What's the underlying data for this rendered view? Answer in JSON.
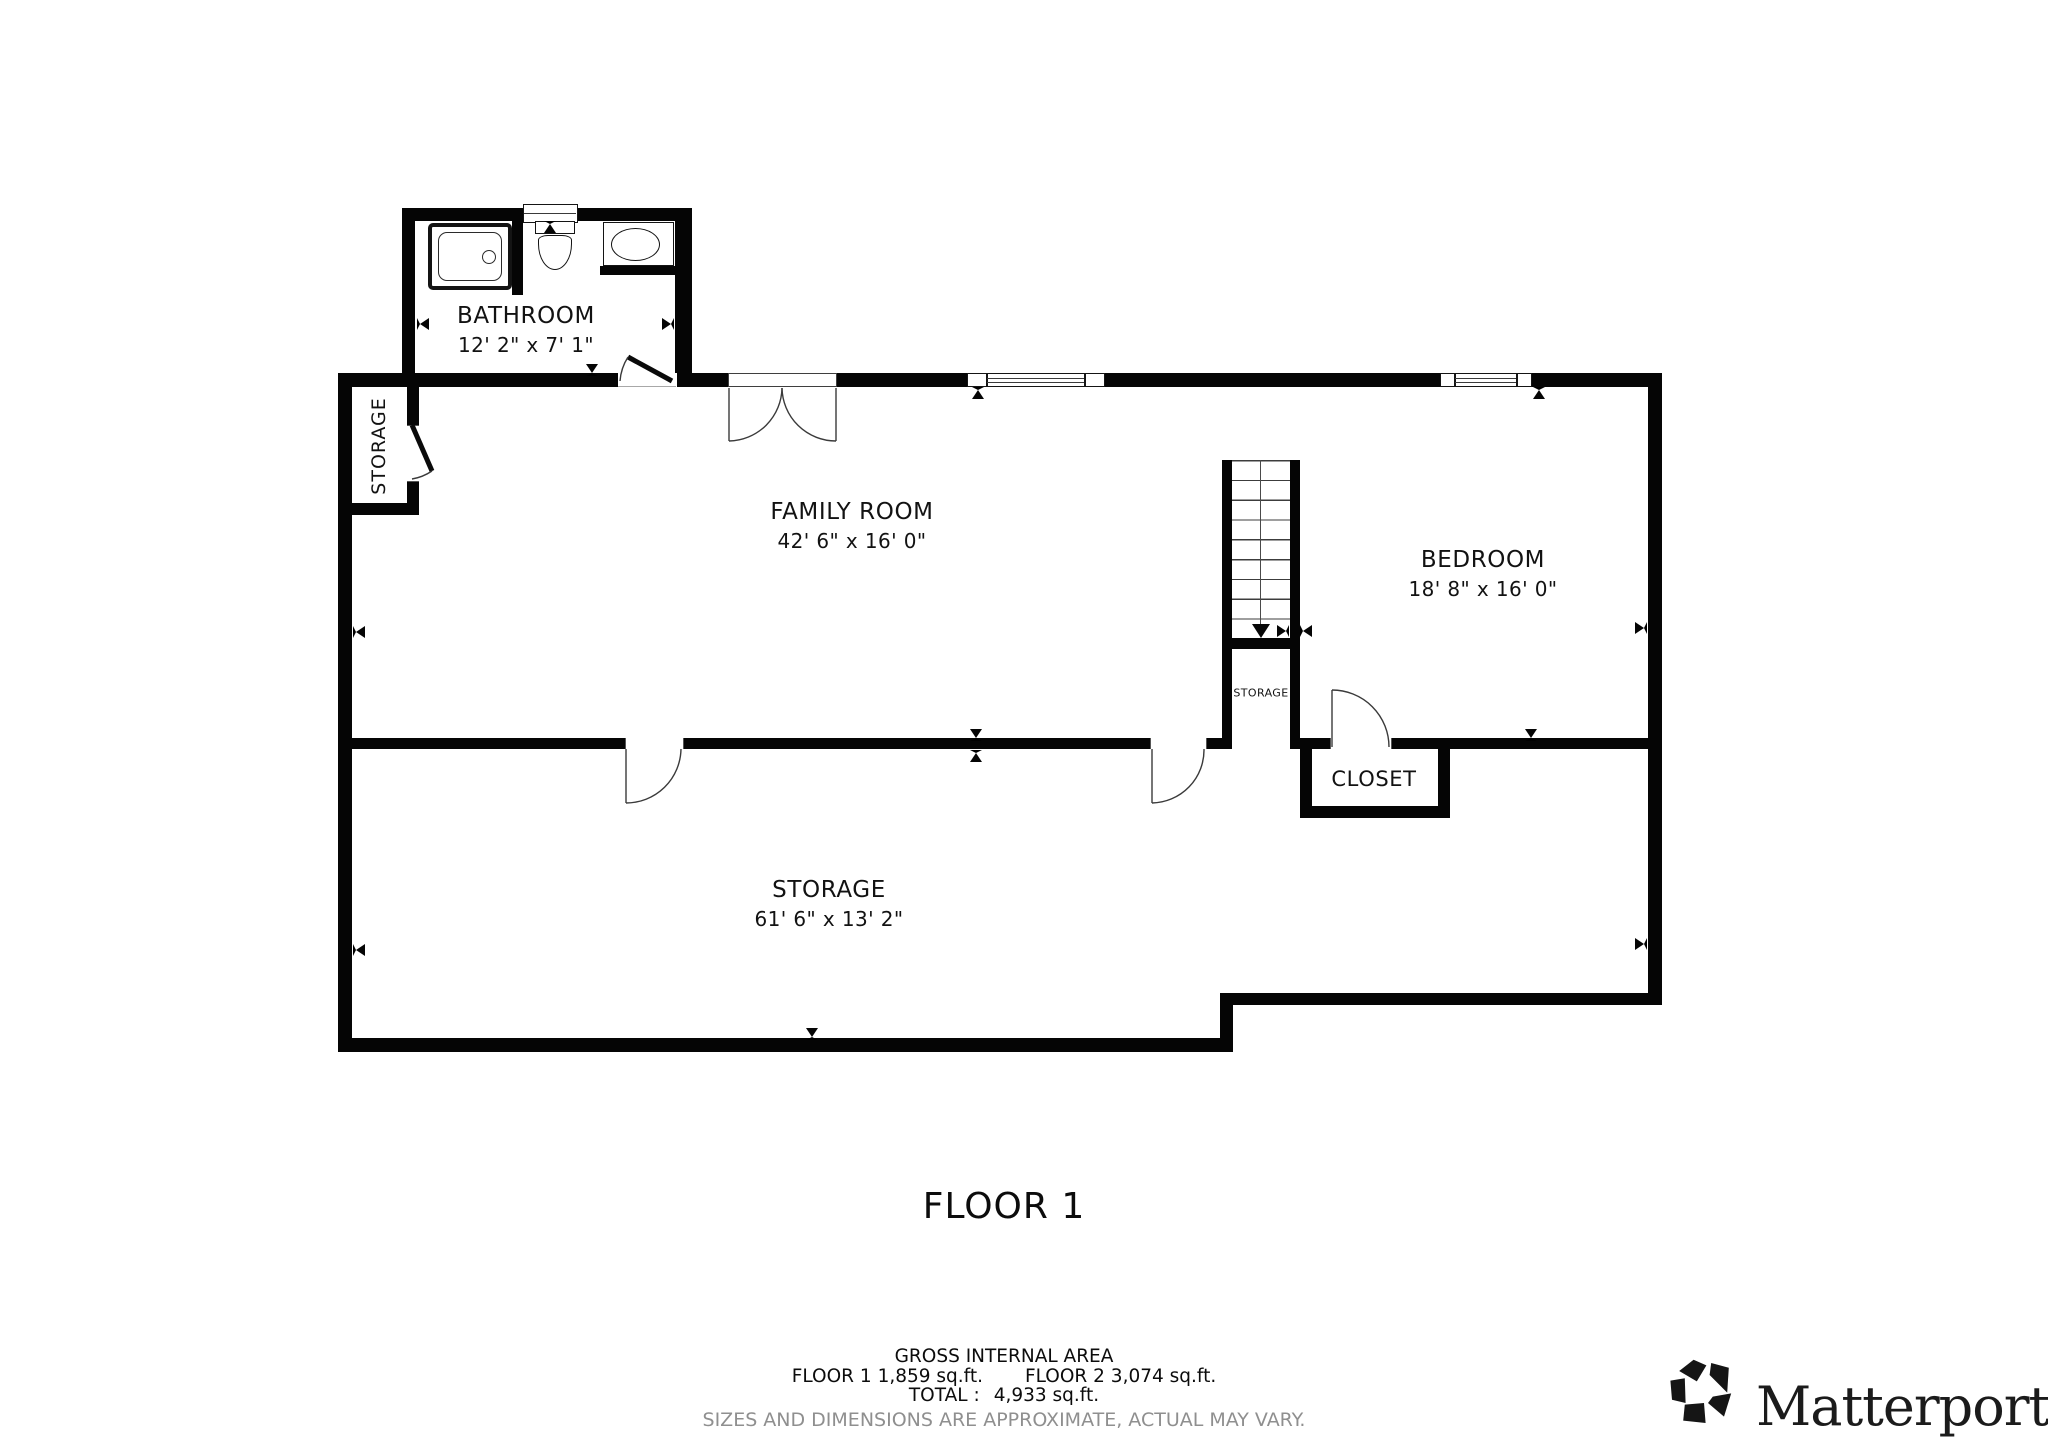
{
  "plan": {
    "title": "FLOOR 1",
    "rooms": {
      "bathroom": {
        "name": "BATHROOM",
        "dims": "12' 2\" x 7' 1\""
      },
      "family_room": {
        "name": "FAMILY ROOM",
        "dims": "42' 6\" x 16' 0\""
      },
      "bedroom": {
        "name": "BEDROOM",
        "dims": "18' 8\" x 16' 0\""
      },
      "storage_main": {
        "name": "STORAGE",
        "dims": "61' 6\" x 13' 2\""
      },
      "storage_left": {
        "name": "STORAGE"
      },
      "storage_under_stairs": {
        "name": "STORAGE"
      },
      "closet": {
        "name": "CLOSET"
      }
    }
  },
  "footer": {
    "gross_heading": "GROSS INTERNAL AREA",
    "floor1_area": "FLOOR 1 1,859 sq.ft.",
    "floor2_area": "FLOOR 2 3,074 sq.ft.",
    "total_label": "TOTAL :",
    "total_value": "4,933 sq.ft.",
    "disclaimer": "SIZES AND DIMENSIONS ARE APPROXIMATE, ACTUAL MAY VARY."
  },
  "branding": {
    "logo_text": "Matterport",
    "registered_mark": "®"
  },
  "colors": {
    "wall": "#050505",
    "background": "#ffffff",
    "disclaimer_text": "#8f8f8f",
    "door_line": "#3a3a3a"
  }
}
